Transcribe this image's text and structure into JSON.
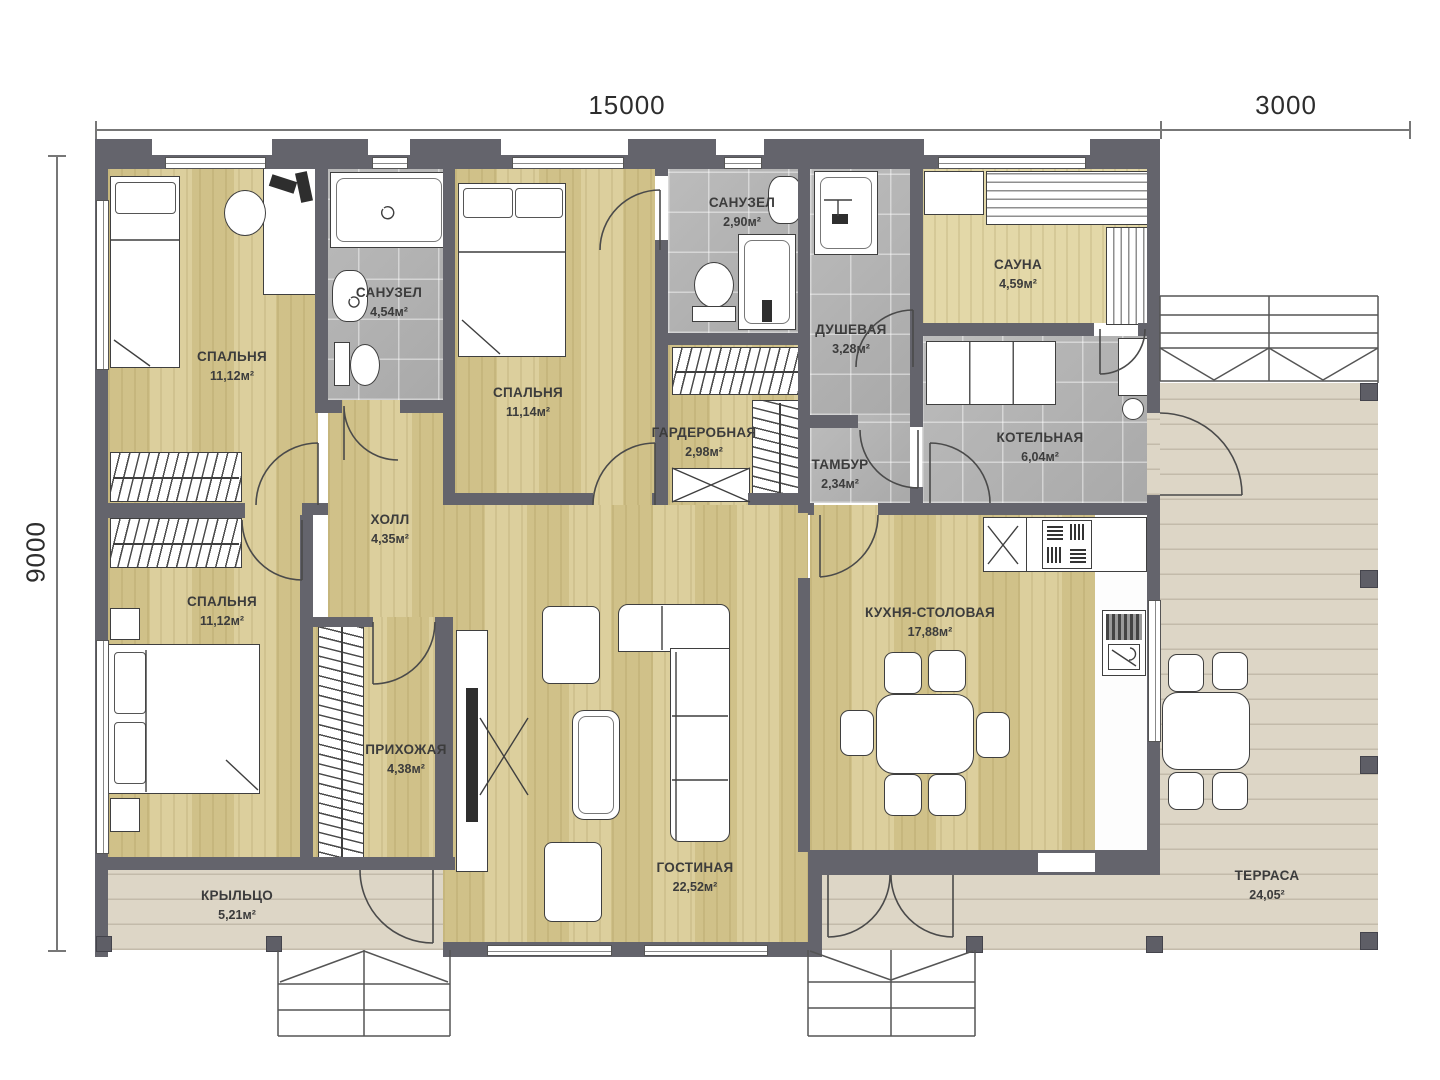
{
  "dimensions": {
    "top_main": "15000",
    "top_right": "3000",
    "left": "9000"
  },
  "rooms": {
    "bedroom1": {
      "name": "СПАЛЬНЯ",
      "area": "11,12м²"
    },
    "bathroom1": {
      "name": "САНУЗЕЛ",
      "area": "4,54м²"
    },
    "bedroom2": {
      "name": "СПАЛЬНЯ",
      "area": "11,14м²"
    },
    "bathroom2": {
      "name": "САНУЗЕЛ",
      "area": "2,90м²"
    },
    "shower_room": {
      "name": "ДУШЕВАЯ",
      "area": "3,28м²"
    },
    "sauna": {
      "name": "САУНА",
      "area": "4,59м²"
    },
    "wardrobe_room": {
      "name": "ГАРДЕРОБНАЯ",
      "area": "2,98м²"
    },
    "vestibule": {
      "name": "ТАМБУР",
      "area": "2,34м²"
    },
    "boiler_room": {
      "name": "КОТЕЛЬНАЯ",
      "area": "6,04м²"
    },
    "hall": {
      "name": "ХОЛЛ",
      "area": "4,35м²"
    },
    "bedroom3": {
      "name": "СПАЛЬНЯ",
      "area": "11,12м²"
    },
    "entry_hall": {
      "name": "ПРИХОЖАЯ",
      "area": "4,38м²"
    },
    "kitchen_dining": {
      "name": "КУХНЯ-СТОЛОВАЯ",
      "area": "17,88м²"
    },
    "living_room": {
      "name": "ГОСТИНАЯ",
      "area": "22,52м²"
    },
    "porch": {
      "name": "КРЫЛЬЦО",
      "area": "5,21м²"
    },
    "terrace": {
      "name": "ТЕРРАСА",
      "area": "24,05²"
    }
  },
  "colors": {
    "wall": "#64646c",
    "wood_floor": "#d8ca92",
    "tile_floor": "#b5b5b5",
    "deck_floor": "#ddd6c6",
    "sauna_wood": "#e3d8a8"
  }
}
